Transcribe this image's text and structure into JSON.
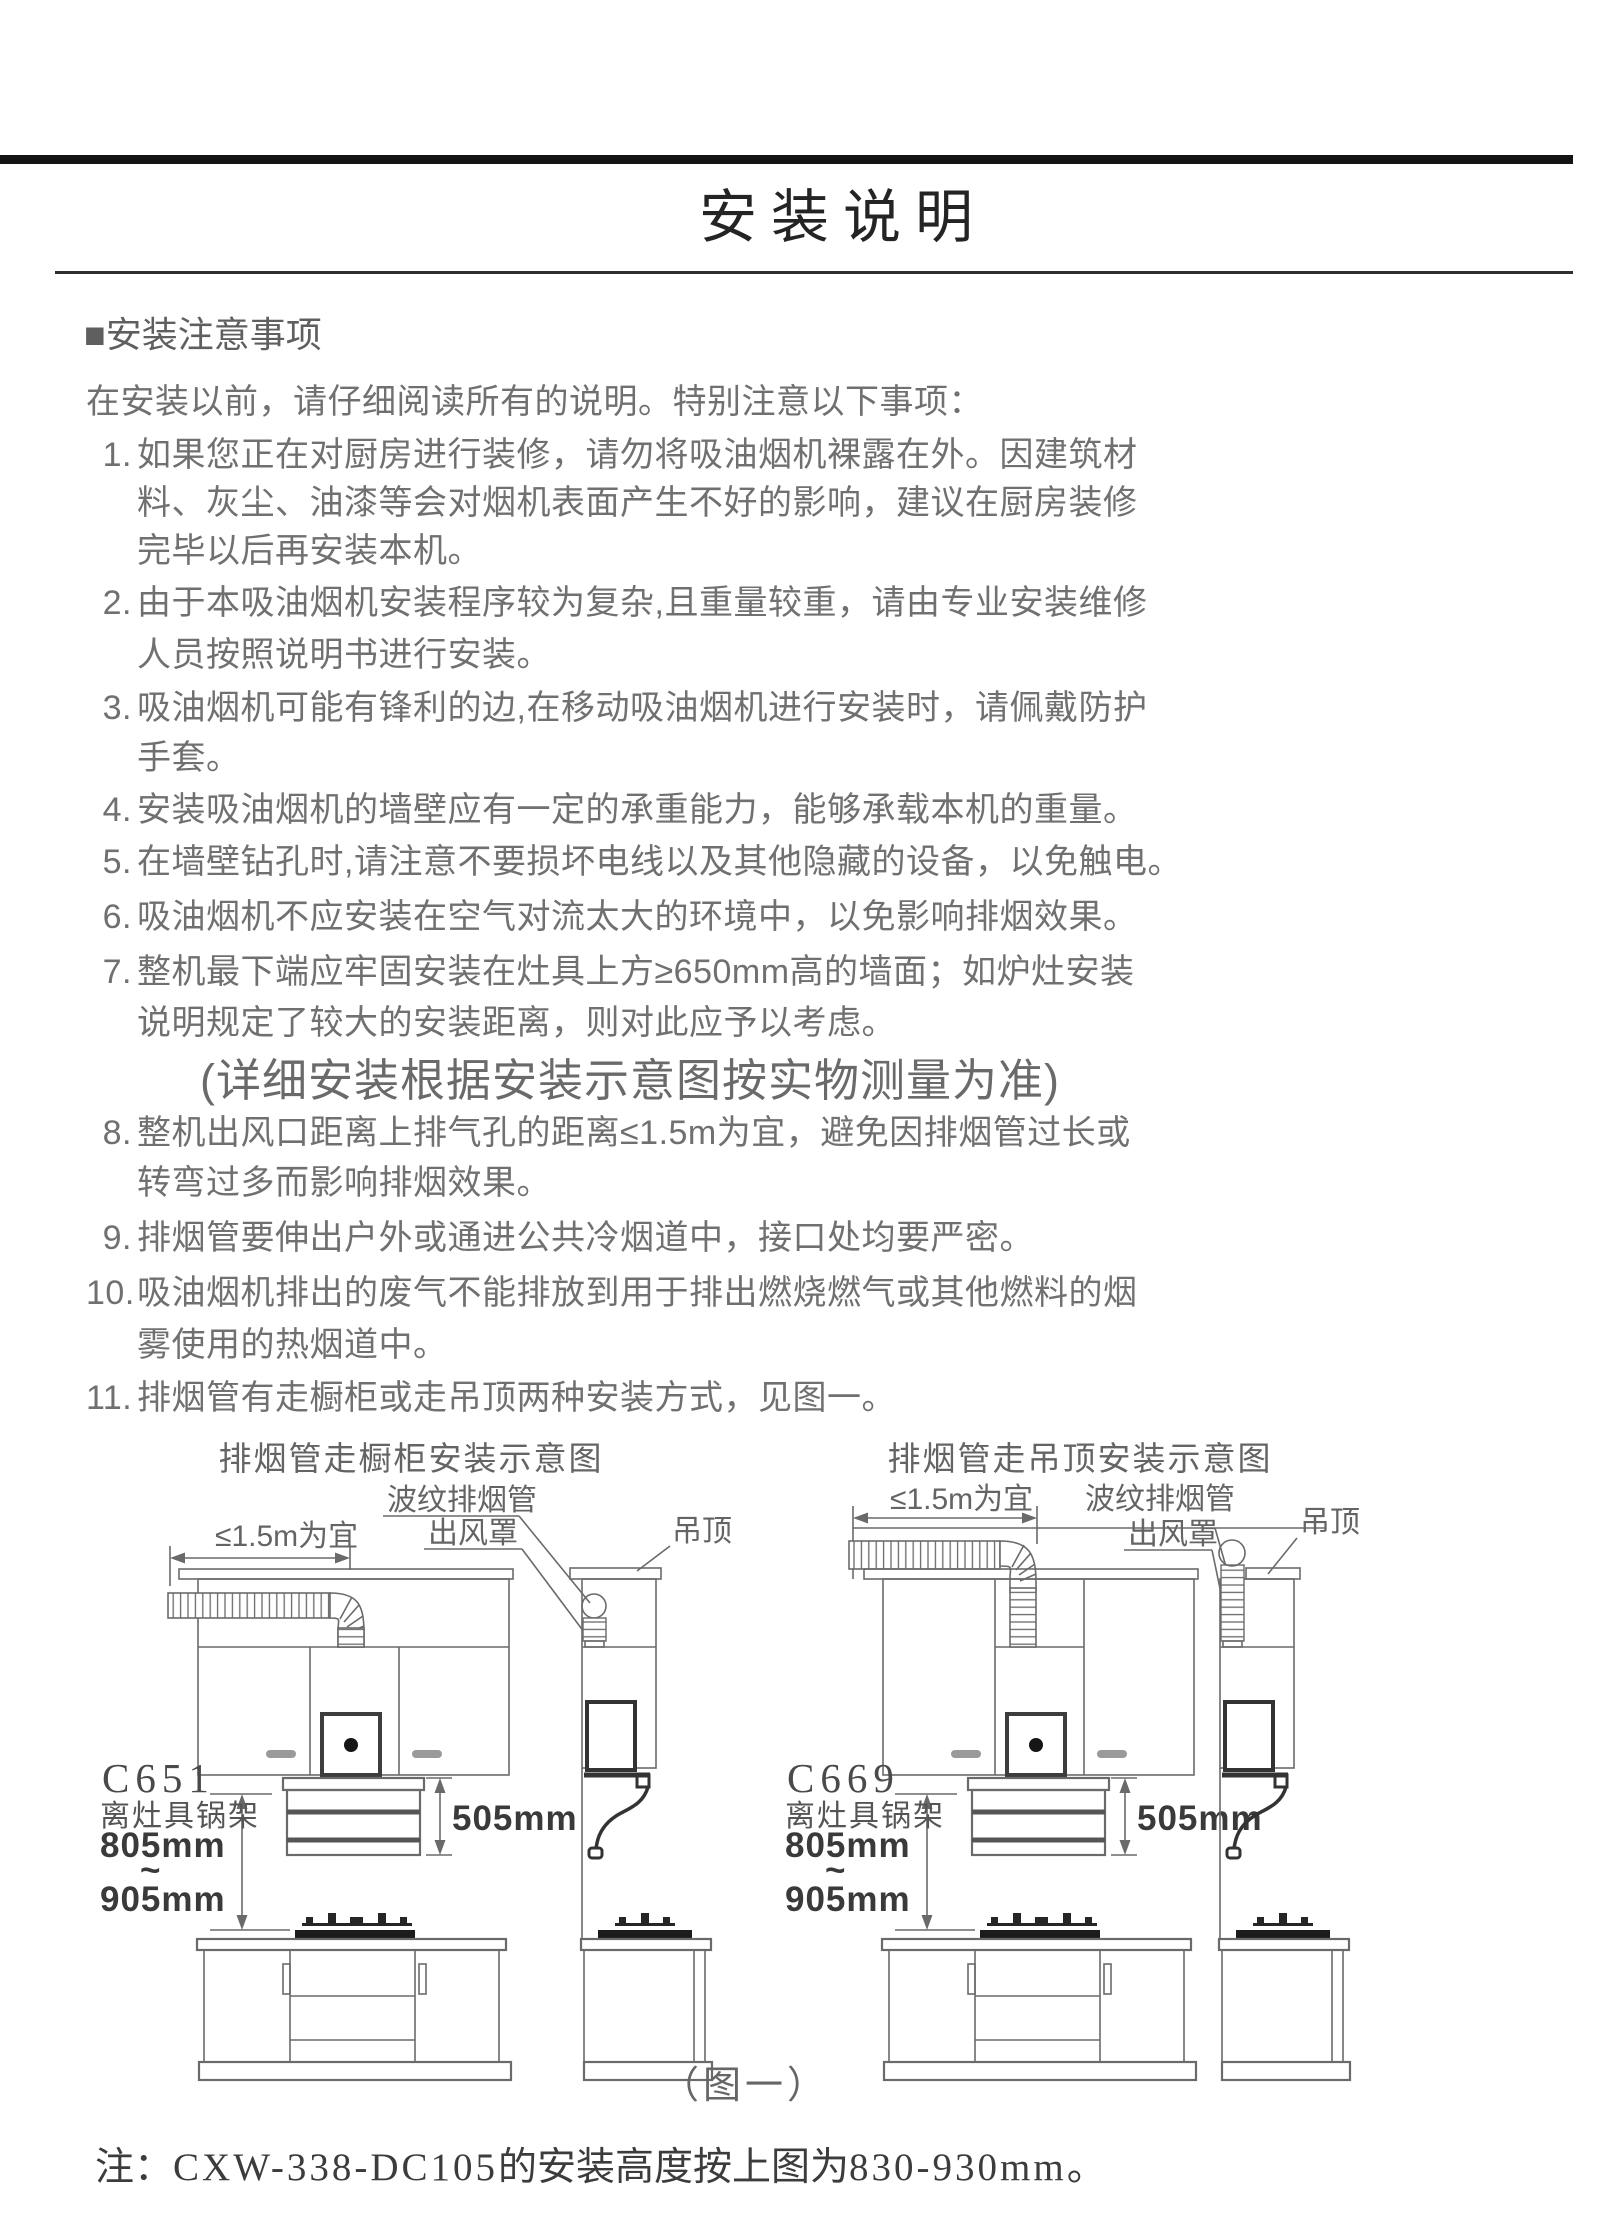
{
  "doc": {
    "title": "安装说明"
  },
  "section": {
    "header": "■安装注意事项"
  },
  "intro": "在安装以前，请仔细阅读所有的说明。特别注意以下事项：",
  "items": [
    {
      "num": "1.",
      "lines": [
        "如果您正在对厨房进行装修，请勿将吸油烟机裸露在外。因建筑材",
        "料、灰尘、油漆等会对烟机表面产生不好的影响，建议在厨房装修",
        "完毕以后再安装本机。"
      ]
    },
    {
      "num": "2.",
      "lines": [
        "由于本吸油烟机安装程序较为复杂,且重量较重，请由专业安装维修",
        "人员按照说明书进行安装。"
      ]
    },
    {
      "num": "3.",
      "lines": [
        "吸油烟机可能有锋利的边,在移动吸油烟机进行安装时，请佩戴防护",
        "手套。"
      ]
    },
    {
      "num": "4.",
      "lines": [
        "安装吸油烟机的墙壁应有一定的承重能力，能够承载本机的重量。"
      ]
    },
    {
      "num": "5.",
      "lines": [
        "在墙壁钻孔时,请注意不要损坏电线以及其他隐藏的设备，以免触电。"
      ]
    },
    {
      "num": "6.",
      "lines": [
        "吸油烟机不应安装在空气对流太大的环境中，以免影响排烟效果。"
      ]
    },
    {
      "num": "7.",
      "lines": [
        "整机最下端应牢固安装在灶具上方≥650mm高的墙面；如炉灶安装",
        "说明规定了较大的安装距离，则对此应予以考虑。"
      ]
    },
    {
      "num": "8.",
      "lines": [
        "整机出风口距离上排气孔的距离≤1.5m为宜，避免因排烟管过长或",
        "转弯过多而影响排烟效果。"
      ]
    },
    {
      "num": "9.",
      "lines": [
        "排烟管要伸出户外或通进公共冷烟道中，接口处均要严密。"
      ]
    },
    {
      "num": "10.",
      "lines": [
        "吸油烟机排出的废气不能排放到用于排出燃烧燃气或其他燃料的烟",
        "雾使用的热烟道中。"
      ]
    },
    {
      "num": "11.",
      "lines": [
        "排烟管有走橱柜或走吊顶两种安装方式，见图一。"
      ]
    }
  ],
  "center_note": "(详细安装根据安装示意图按实物测量为准)",
  "figure": {
    "left": {
      "title": "排烟管走橱柜安装示意图",
      "model": "C651"
    },
    "right": {
      "title": "排烟管走吊顶安装示意图",
      "model": "C669"
    },
    "labels": {
      "pipe": "波纹排烟管",
      "outlet": "出风罩",
      "ceiling": "吊顶",
      "max_run": "≤1.5m为宜",
      "hood_height": "505mm",
      "clearance": "离灶具锅架",
      "height_min": "805mm",
      "tilde": "~",
      "height_max": "905mm"
    },
    "caption": "（图一）"
  },
  "footnote": {
    "prefix": "注：",
    "model": "CXW-338-DC105",
    "middle": "的安装高度按上图为",
    "range": "830-930mm。"
  }
}
